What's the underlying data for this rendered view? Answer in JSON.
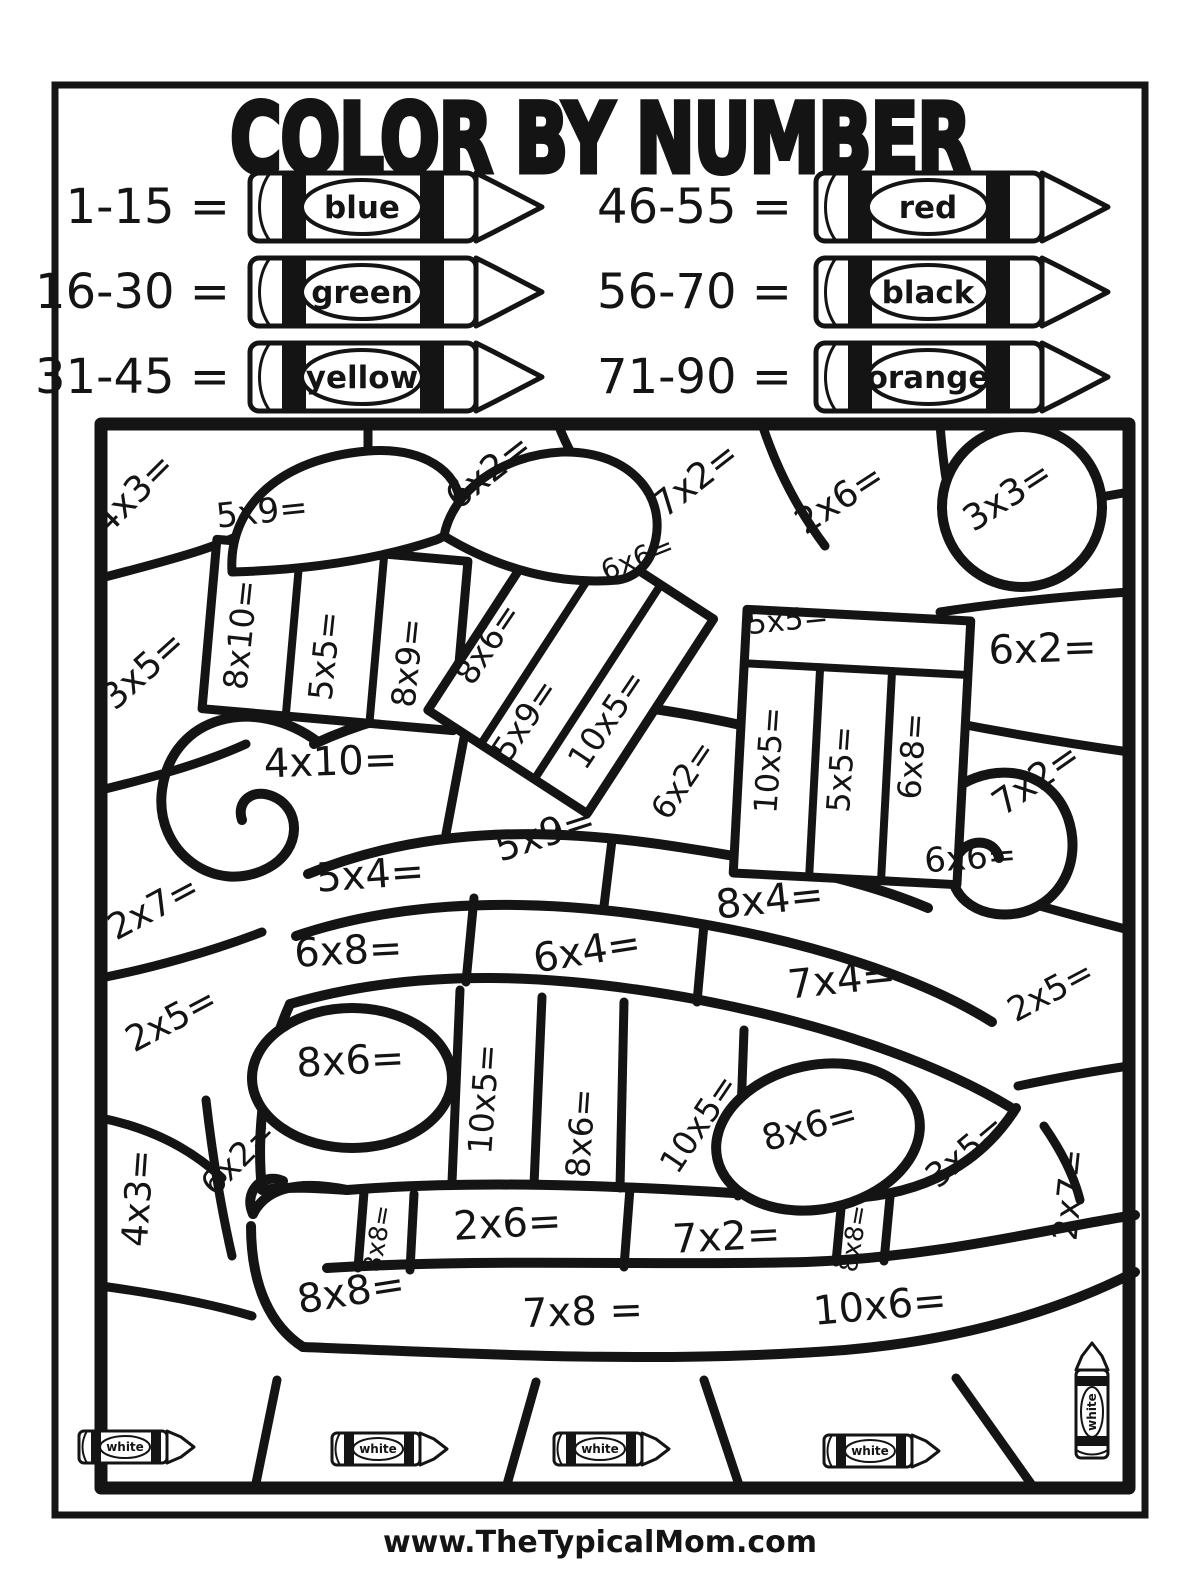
{
  "page": {
    "title": "COLOR BY NUMBER",
    "footer": "www.TheTypicalMom.com"
  },
  "colors": {
    "ink": "#141414",
    "paper": "#ffffff"
  },
  "legend": {
    "items": [
      {
        "range": "1-15 =",
        "color": "blue"
      },
      {
        "range": "16-30 =",
        "color": "green"
      },
      {
        "range": "31-45 =",
        "color": "yellow"
      },
      {
        "range": "46-55 =",
        "color": "red"
      },
      {
        "range": "56-70 =",
        "color": "black"
      },
      {
        "range": "71-90 =",
        "color": "orange"
      }
    ]
  },
  "puzzle": {
    "white_crayon_label": "white",
    "problems": [
      {
        "label": "4x3=",
        "x": 142,
        "y": 502,
        "rot": -45,
        "size": 36
      },
      {
        "label": "5x9=",
        "x": 263,
        "y": 523,
        "rot": -6,
        "size": 34
      },
      {
        "label": "6x2=",
        "x": 496,
        "y": 481,
        "rot": -38,
        "size": 36
      },
      {
        "label": "7x2=",
        "x": 703,
        "y": 489,
        "rot": -38,
        "size": 36
      },
      {
        "label": "2x6=",
        "x": 846,
        "y": 509,
        "rot": -33,
        "size": 36
      },
      {
        "label": "3x3=",
        "x": 1014,
        "y": 506,
        "rot": -33,
        "size": 36
      },
      {
        "label": "3x5=",
        "x": 151,
        "y": 679,
        "rot": -42,
        "size": 36
      },
      {
        "label": "8x10=",
        "x": 252,
        "y": 636,
        "rot": -84,
        "size": 33
      },
      {
        "label": "5x5=",
        "x": 336,
        "y": 657,
        "rot": -84,
        "size": 33
      },
      {
        "label": "8x9=",
        "x": 419,
        "y": 664,
        "rot": -84,
        "size": 33
      },
      {
        "label": "8x6=",
        "x": 497,
        "y": 650,
        "rot": -56,
        "size": 33
      },
      {
        "label": "5x9=",
        "x": 534,
        "y": 726,
        "rot": -56,
        "size": 33
      },
      {
        "label": "10x5=",
        "x": 616,
        "y": 726,
        "rot": -56,
        "size": 33
      },
      {
        "label": "6x6=",
        "x": 641,
        "y": 567,
        "rot": -22,
        "size": 28
      },
      {
        "label": "6x2=",
        "x": 692,
        "y": 786,
        "rot": -56,
        "size": 32
      },
      {
        "label": "5x5=",
        "x": 789,
        "y": 630,
        "rot": -6,
        "size": 30
      },
      {
        "label": "10x5=",
        "x": 780,
        "y": 761,
        "rot": -86,
        "size": 32
      },
      {
        "label": "5x5=",
        "x": 852,
        "y": 770,
        "rot": -86,
        "size": 32
      },
      {
        "label": "6x8=",
        "x": 923,
        "y": 757,
        "rot": -86,
        "size": 32
      },
      {
        "label": "6x2=",
        "x": 1043,
        "y": 662,
        "rot": -2,
        "size": 40
      },
      {
        "label": "7x2=",
        "x": 1043,
        "y": 789,
        "rot": -35,
        "size": 36
      },
      {
        "label": "4x10=",
        "x": 331,
        "y": 775,
        "rot": -2,
        "size": 40
      },
      {
        "label": "5x9=",
        "x": 549,
        "y": 846,
        "rot": -18,
        "size": 38
      },
      {
        "label": "5x4=",
        "x": 371,
        "y": 888,
        "rot": -4,
        "size": 40
      },
      {
        "label": "8x4=",
        "x": 771,
        "y": 913,
        "rot": -6,
        "size": 40
      },
      {
        "label": "6x6=",
        "x": 971,
        "y": 869,
        "rot": -4,
        "size": 34
      },
      {
        "label": "2x7=",
        "x": 159,
        "y": 918,
        "rot": -28,
        "size": 36
      },
      {
        "label": "6x8=",
        "x": 349,
        "y": 964,
        "rot": -3,
        "size": 40
      },
      {
        "label": "6x4=",
        "x": 589,
        "y": 964,
        "rot": -9,
        "size": 40
      },
      {
        "label": "7x4=",
        "x": 843,
        "y": 993,
        "rot": -6,
        "size": 40
      },
      {
        "label": "2x5=",
        "x": 1056,
        "y": 1001,
        "rot": -28,
        "size": 34
      },
      {
        "label": "2x5=",
        "x": 177,
        "y": 1030,
        "rot": -28,
        "size": 36
      },
      {
        "label": "8x6=",
        "x": 351,
        "y": 1074,
        "rot": -3,
        "size": 40
      },
      {
        "label": "10x5=",
        "x": 495,
        "y": 1100,
        "rot": -86,
        "size": 33
      },
      {
        "label": "8x6=",
        "x": 592,
        "y": 1134,
        "rot": -86,
        "size": 33
      },
      {
        "label": "10x5=",
        "x": 708,
        "y": 1130,
        "rot": -56,
        "size": 33
      },
      {
        "label": "8x6=",
        "x": 813,
        "y": 1138,
        "rot": -16,
        "size": 36
      },
      {
        "label": "3x5=",
        "x": 973,
        "y": 1160,
        "rot": -40,
        "size": 34
      },
      {
        "label": "2x7=",
        "x": 1081,
        "y": 1196,
        "rot": -84,
        "size": 34
      },
      {
        "label": "4x3=",
        "x": 150,
        "y": 1199,
        "rot": -86,
        "size": 36
      },
      {
        "label": "6x2=",
        "x": 246,
        "y": 1166,
        "rot": -45,
        "size": 33
      },
      {
        "label": "8x8=",
        "x": 386,
        "y": 1240,
        "rot": -80,
        "size": 25
      },
      {
        "label": "2x6=",
        "x": 508,
        "y": 1237,
        "rot": -3,
        "size": 40
      },
      {
        "label": "7x2=",
        "x": 727,
        "y": 1250,
        "rot": -3,
        "size": 40
      },
      {
        "label": "8x8=",
        "x": 862,
        "y": 1240,
        "rot": -80,
        "size": 25
      },
      {
        "label": "8x8=",
        "x": 353,
        "y": 1305,
        "rot": -9,
        "size": 40
      },
      {
        "label": "7x8 =",
        "x": 583,
        "y": 1325,
        "rot": -2,
        "size": 40
      },
      {
        "label": "10x6=",
        "x": 881,
        "y": 1319,
        "rot": -5,
        "size": 40
      }
    ]
  }
}
